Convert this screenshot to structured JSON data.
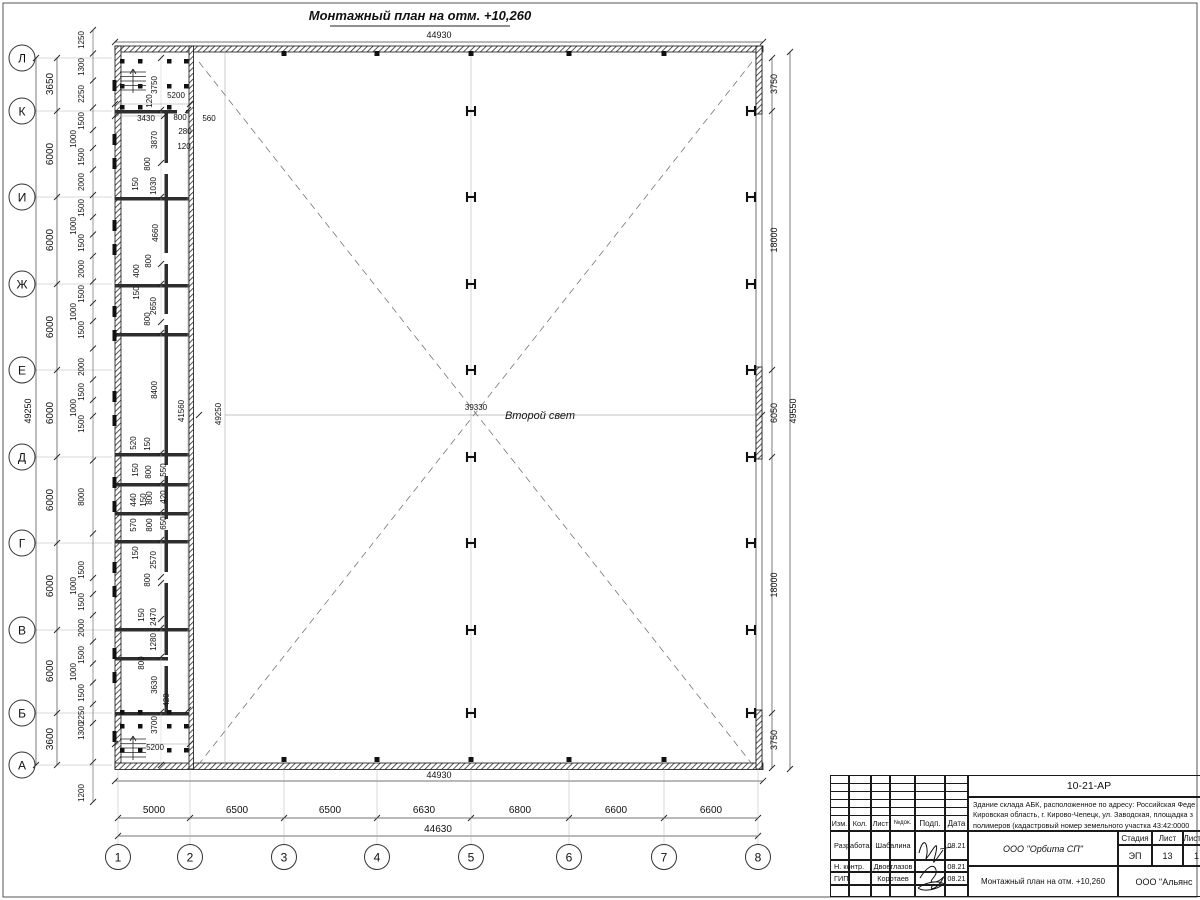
{
  "sheet": {
    "title": "Монтажный план на отм. +10,260"
  },
  "plan": {
    "center_label": "Второй свет",
    "overall_top": "44930",
    "overall_bottom": "44930",
    "overall_bottom2": "44630",
    "overall_left": "49250",
    "overall_right": "49550",
    "rows": [
      [
        "Л",
        58
      ],
      [
        "К",
        111
      ],
      [
        "И",
        197
      ],
      [
        "Ж",
        284
      ],
      [
        "Е",
        370
      ],
      [
        "Д",
        457
      ],
      [
        "Г",
        543
      ],
      [
        "В",
        630
      ],
      [
        "Б",
        713
      ],
      [
        "А",
        765
      ]
    ],
    "cols": [
      [
        "1",
        118
      ],
      [
        "2",
        190
      ],
      [
        "3",
        284
      ],
      [
        "4",
        377
      ],
      [
        "5",
        471
      ],
      [
        "6",
        569
      ],
      [
        "7",
        664
      ],
      [
        "8",
        758
      ]
    ],
    "row_dims": [
      [
        "3650",
        84
      ],
      [
        "6000",
        154
      ],
      [
        "6000",
        240
      ],
      [
        "6000",
        327
      ],
      [
        "6000",
        413
      ],
      [
        "6000",
        500
      ],
      [
        "6000",
        586
      ],
      [
        "6000",
        671
      ],
      [
        "3600",
        739
      ]
    ],
    "col_dims": [
      [
        "5000",
        154
      ],
      [
        "6500",
        237
      ],
      [
        "6500",
        330
      ],
      [
        "6630",
        424
      ],
      [
        "6800",
        520
      ],
      [
        "6600",
        616
      ],
      [
        "6600",
        711
      ]
    ],
    "right_dims": [
      [
        "3750",
        84
      ],
      [
        "18000",
        240
      ],
      [
        "6050",
        413
      ],
      [
        "18000",
        585
      ],
      [
        "3750",
        740
      ]
    ],
    "left_window_dims": [
      [
        "1250",
        40
      ],
      [
        "1300",
        67
      ],
      [
        "2250",
        94
      ],
      [
        "1500",
        121
      ],
      [
        "1000",
        139
      ],
      [
        "1500",
        157
      ],
      [
        "2000",
        182
      ],
      [
        "1500",
        208
      ],
      [
        "1000",
        226
      ],
      [
        "1500",
        243
      ],
      [
        "2000",
        269
      ],
      [
        "1500",
        294
      ],
      [
        "1000",
        312
      ],
      [
        "1500",
        330
      ],
      [
        "2000",
        367
      ],
      [
        "1500",
        392
      ],
      [
        "1000",
        408
      ],
      [
        "1500",
        424
      ],
      [
        "8000",
        497
      ],
      [
        "1500",
        570
      ],
      [
        "1000",
        586
      ],
      [
        "1500",
        602
      ],
      [
        "2000",
        628
      ],
      [
        "1500",
        655
      ],
      [
        "1000",
        672
      ],
      [
        "1500",
        693
      ],
      [
        "2250",
        715
      ],
      [
        "1300",
        731
      ],
      [
        "1200",
        793
      ]
    ],
    "inner_dims": [
      [
        "3750",
        157,
        85,
        1
      ],
      [
        "5200",
        176,
        98,
        0
      ],
      [
        "120",
        152,
        101,
        1
      ],
      [
        "3430",
        146,
        121,
        0
      ],
      [
        "800",
        180,
        120,
        0
      ],
      [
        "560",
        209,
        121,
        0
      ],
      [
        "280",
        185,
        134,
        0
      ],
      [
        "120",
        184,
        149,
        0
      ],
      [
        "3870",
        157,
        140,
        1
      ],
      [
        "800",
        150,
        164,
        1
      ],
      [
        "150",
        138,
        184,
        1
      ],
      [
        "1030",
        156,
        186,
        1
      ],
      [
        "4660",
        158,
        233,
        1
      ],
      [
        "800",
        151,
        261,
        1
      ],
      [
        "400",
        139,
        271,
        1
      ],
      [
        "150",
        139,
        293,
        1
      ],
      [
        "2650",
        156,
        306,
        1
      ],
      [
        "800",
        150,
        319,
        1
      ],
      [
        "8400",
        157,
        390,
        1
      ],
      [
        "41560",
        184,
        411,
        1
      ],
      [
        "49250",
        221,
        414,
        1
      ],
      [
        "39330",
        476,
        410,
        0
      ],
      [
        "520",
        136,
        443,
        1
      ],
      [
        "150",
        150,
        444,
        1
      ],
      [
        "150",
        138,
        470,
        1
      ],
      [
        "800",
        151,
        472,
        1
      ],
      [
        "550",
        166,
        470,
        1
      ],
      [
        "440",
        136,
        500,
        1
      ],
      [
        "150",
        146,
        500,
        1
      ],
      [
        "800",
        152,
        498,
        1
      ],
      [
        "420",
        166,
        497,
        1
      ],
      [
        "570",
        136,
        525,
        1
      ],
      [
        "800",
        152,
        525,
        1
      ],
      [
        "650",
        166,
        523,
        1
      ],
      [
        "150",
        138,
        553,
        1
      ],
      [
        "2570",
        156,
        560,
        1
      ],
      [
        "800",
        150,
        580,
        1
      ],
      [
        "2470",
        156,
        617,
        1
      ],
      [
        "150",
        144,
        615,
        1
      ],
      [
        "1280",
        156,
        642,
        1
      ],
      [
        "800",
        144,
        663,
        1
      ],
      [
        "3630",
        157,
        685,
        1
      ],
      [
        "420",
        169,
        700,
        1
      ],
      [
        "3700",
        157,
        725,
        1
      ],
      [
        "5200",
        155,
        750,
        0
      ]
    ]
  },
  "titleblock": {
    "doc_number": "10-21-АР",
    "description_lines": [
      "Здание склада АБК, расположенное по адресу: Российская Феде",
      "Кировская область, г. Кирово-Чепецк, ул. Заводская, площадка з",
      "полимеров (кадастровый номер земельного участка 43:42:0000"
    ],
    "cols": [
      "Изм.",
      "Кол.",
      "Лист",
      "№док.",
      "Подп.",
      "Дата"
    ],
    "rows": [
      [
        "Разработал",
        "Шабалина",
        "08.21"
      ],
      [
        "Н. контр.",
        "Двоеглазов",
        "08.21"
      ],
      [
        "ГИП",
        "Коротаев",
        "08.21"
      ]
    ],
    "org": "ООО \"Орбита СП\"",
    "stage_label": "Стадия",
    "sheet_label": "Лист",
    "sheets_label": "Листов",
    "stage": "ЭП",
    "sheet_no": "13",
    "sheets_total": "1",
    "plan_name": "Монтажный план на отм. +10,260",
    "company": "ООО \"Альянс"
  }
}
